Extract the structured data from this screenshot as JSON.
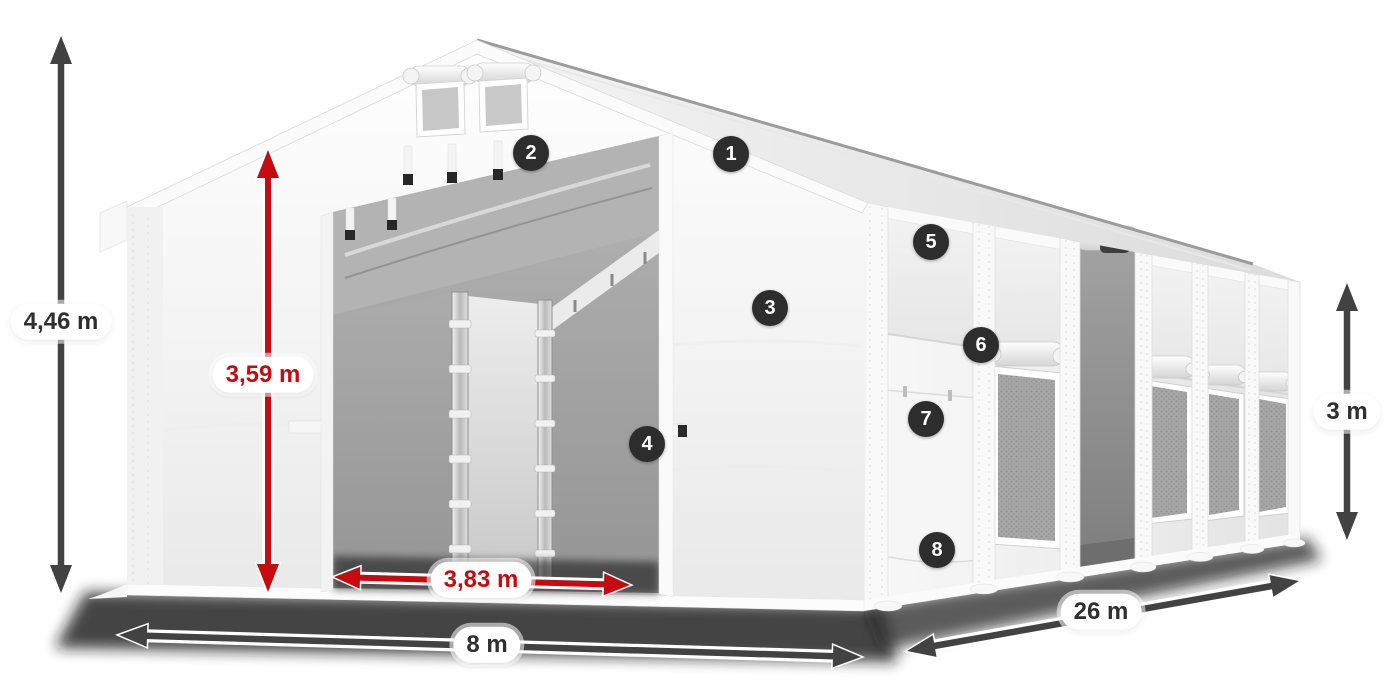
{
  "product_diagram": {
    "type": "tent-dimension-diagram",
    "dimensions": {
      "total_height": "4,46 m",
      "entrance_height": "3,59 m",
      "entrance_width": "3,83 m",
      "width": "8 m",
      "length": "26 m",
      "wall_height": "3 m"
    },
    "callouts": [
      {
        "number": "1"
      },
      {
        "number": "2"
      },
      {
        "number": "3"
      },
      {
        "number": "4"
      },
      {
        "number": "5"
      },
      {
        "number": "6"
      },
      {
        "number": "7"
      },
      {
        "number": "8"
      }
    ],
    "colors": {
      "highlight_red": "#c60b10",
      "arrow_dark": "#424242",
      "badge_background": "#2d2d2d",
      "badge_text": "#ffffff",
      "label_background": "#ffffff",
      "label_text_dark": "#2f2f2f",
      "background": "#ffffff"
    }
  }
}
